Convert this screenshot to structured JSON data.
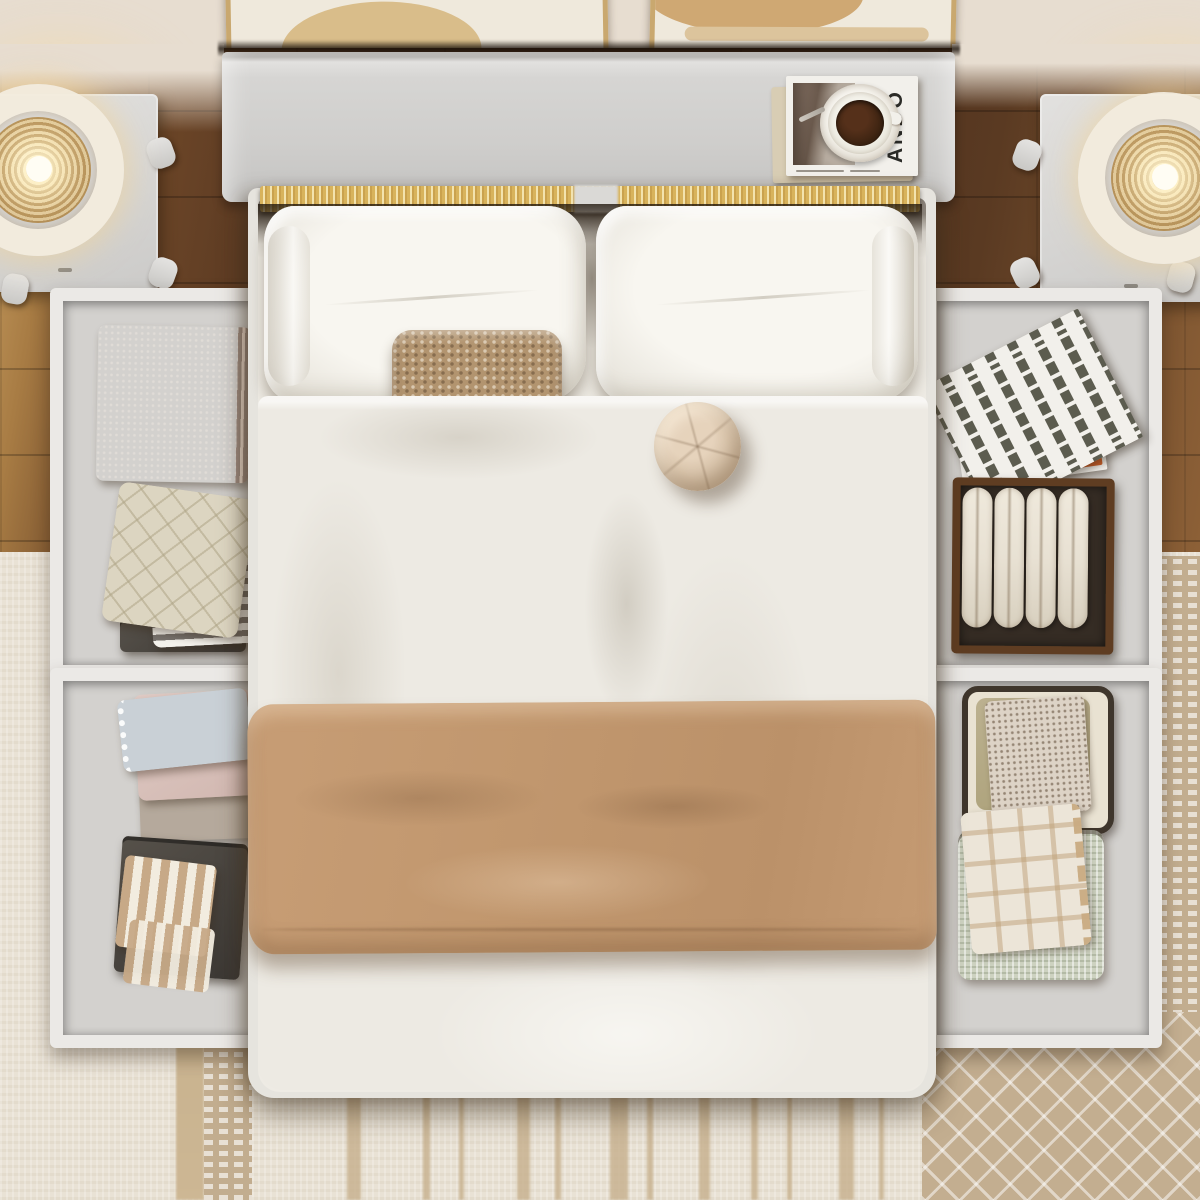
{
  "scene": {
    "type": "photograph",
    "description": "Top-down render of a bedroom: white storage platform bed with headboard shelf, four pull-out under-bed drawers holding folded blankets, rolled towels, boxes and magazines, flanked by two white nightstands with glowing ring lamps, set on wood flooring and layered cream/tan patterned rugs.",
    "headboard_book_title": "ANDO"
  },
  "palette": {
    "wall": "#e7ddd0",
    "wood_dark": "#4e311f",
    "wood_mid": "#7c5430",
    "wood_light": "#c79e62",
    "furniture_white": "#e8e7e4",
    "drawer_interior": "#d3d1ce",
    "drawer_frame": "#ebe9e6",
    "bedding_white": "#efece5",
    "duvet_shade": "#e6e2da",
    "blanket_camel": "#c19770",
    "knit_tan": "#b2946f",
    "round_tan": "#d5c0a6",
    "stripe_gold": "#d8b35c",
    "rug_cream": "#e9e2d5",
    "rug_tan": "#c2ad8f",
    "lamp_glow": "#f5d9a8",
    "lamp_gold": "#c9a362",
    "box_brown": "#5f3d22",
    "towel_cream": "#e8e1d3",
    "sage": "#cdd2c0",
    "rose": "#c09e8d",
    "plaid_cream": "#ece5d8",
    "coffee": "#36200f",
    "frame_gold": "#c9a86f",
    "canvas": "#efe9dc",
    "mag_white": "#f2f0eb",
    "charcoal": "#3b3733"
  }
}
